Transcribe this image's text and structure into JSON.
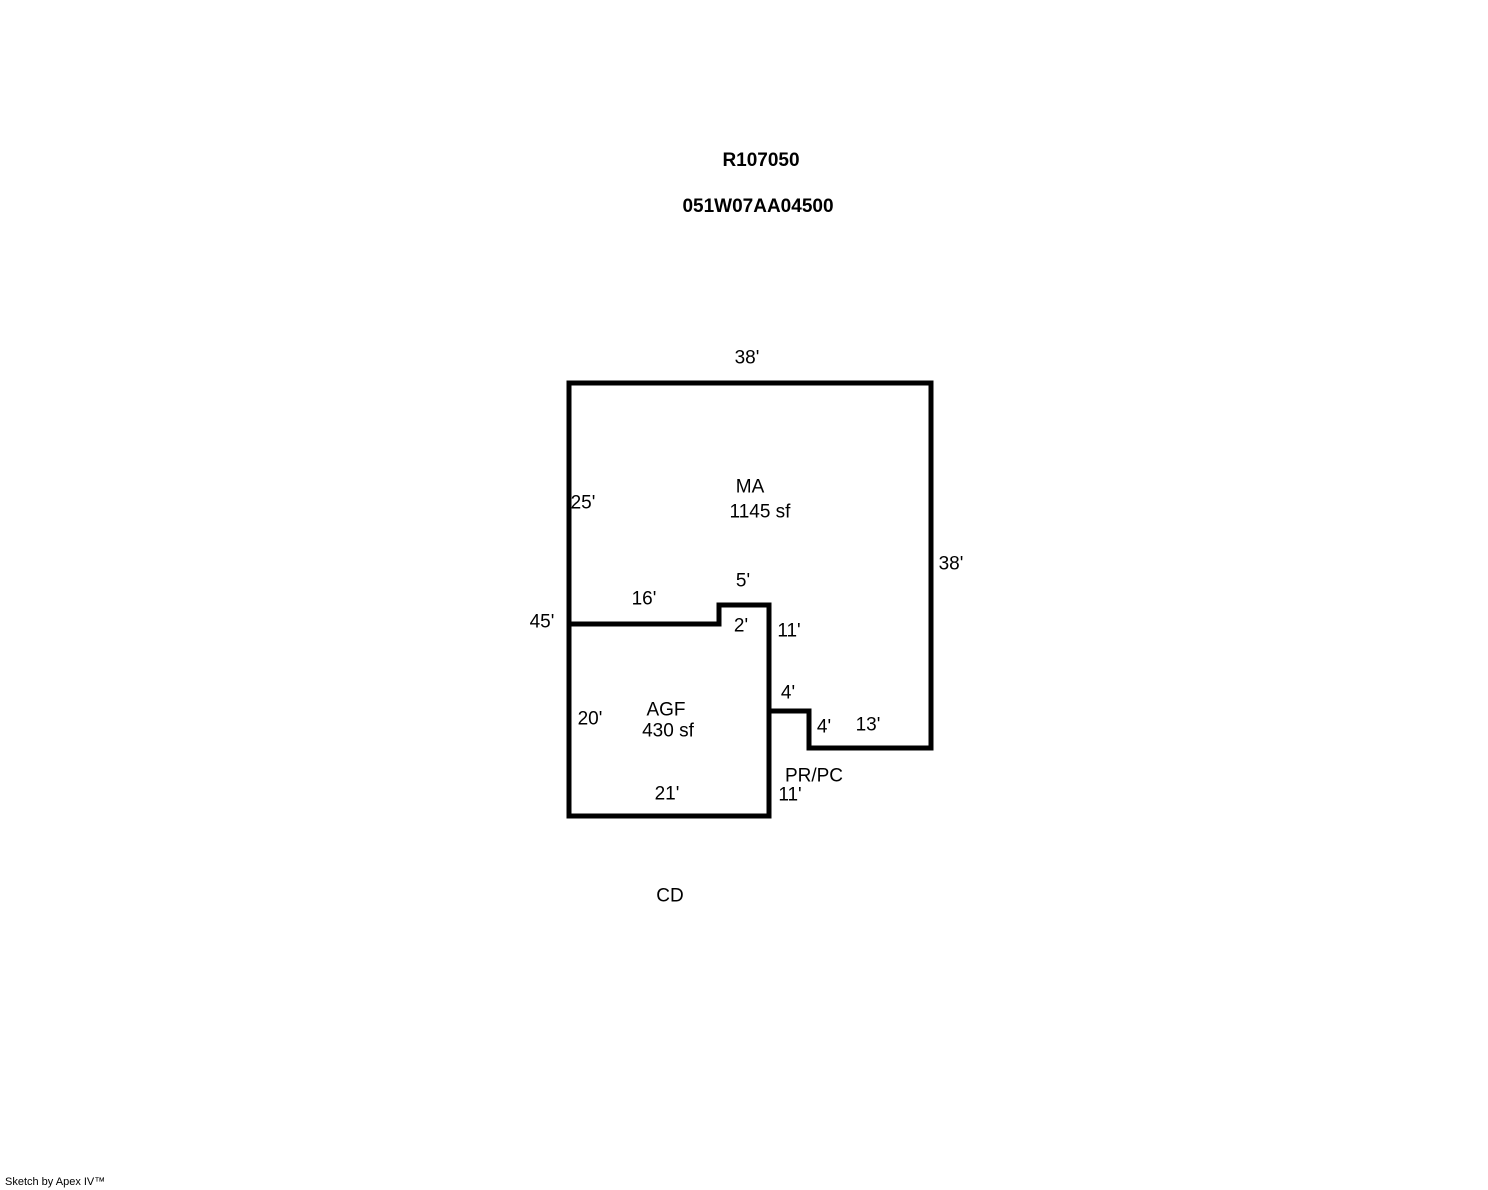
{
  "header": {
    "record_number": "R107050",
    "parcel_number": "051W07AA04500"
  },
  "floorplan": {
    "areas": {
      "ma": {
        "code": "MA",
        "area": "1145 sf"
      },
      "agf": {
        "code": "AGF",
        "area": "430 sf"
      },
      "prpc": {
        "code": "PR/PC"
      },
      "cd": {
        "code": "CD"
      }
    },
    "dims": {
      "top_38": "38'",
      "left_25": "25'",
      "right_38": "38'",
      "notch_5": "5'",
      "mid_16": "16'",
      "left_45": "45'",
      "notch_2": "2'",
      "right_11_upper": "11'",
      "step_4_upper": "4'",
      "left_20": "20'",
      "step_4_lower": "4'",
      "bottom_13": "13'",
      "prpc_11": "11'",
      "bottom_21": "21'"
    },
    "outline_color": "#000000"
  },
  "footer": {
    "credit": "Sketch by Apex IV™"
  }
}
